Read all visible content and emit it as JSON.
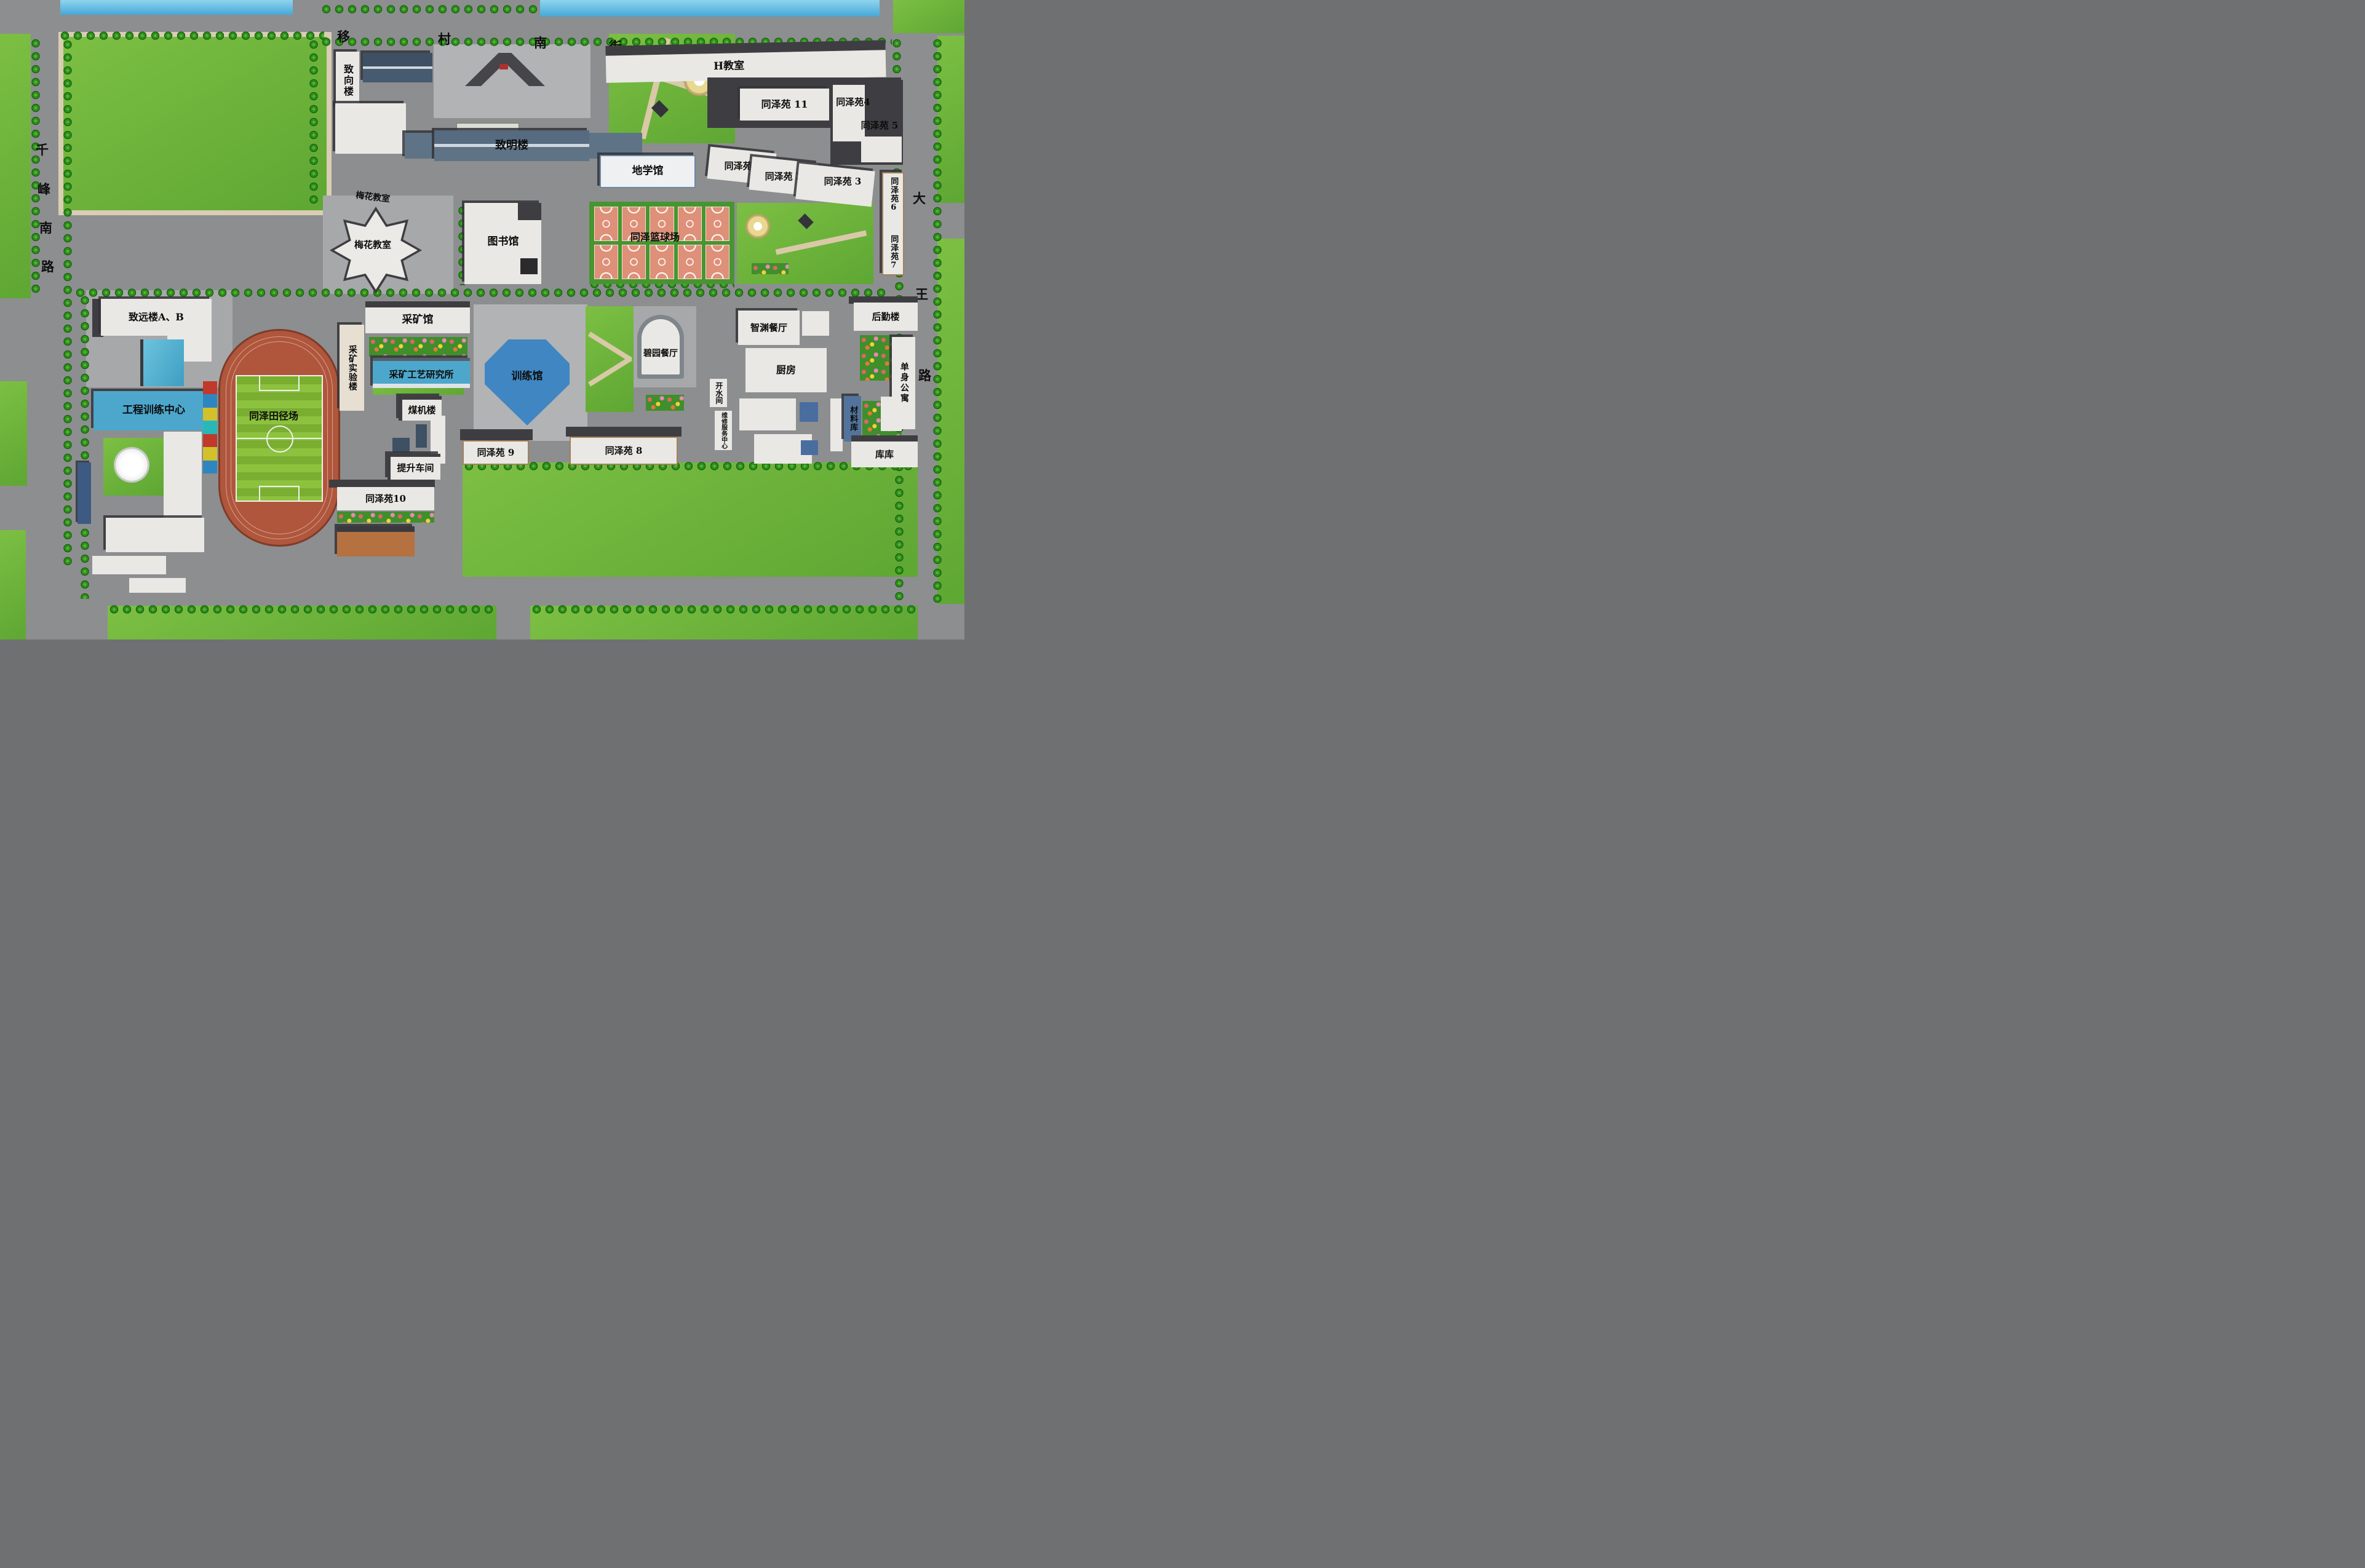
{
  "streets": {
    "north": [
      "移",
      "村",
      "南",
      "街"
    ],
    "west": [
      "千",
      "峰",
      "南",
      "路"
    ],
    "east": [
      "大",
      "王",
      "路"
    ]
  },
  "labels": {
    "zhixianglou": "致向楼",
    "zhiminglou": "致明楼",
    "h_jiaoshi": "H教室",
    "tzy11": "同泽苑 11",
    "tzy4": "同泽苑4",
    "tzy5": "同泽苑 5",
    "dixueguan": "地学馆",
    "tzy1": "同泽苑 1",
    "tzy2": "同泽苑 2",
    "tzy3": "同泽苑 3",
    "tzy6": "同泽苑6",
    "tzy7": "同泽苑7",
    "meihua_small": "梅花教室",
    "meihua": "梅花教室",
    "tushuguan": "图书馆",
    "lanqiuchang": "同泽篮球场",
    "zhiyuanlou_ab": "致远楼A、B",
    "gongcheng_xunlian": "工程训练中心",
    "tianjingchang": "同泽田径场",
    "caikuangguan": "采矿馆",
    "caikuang_shiyanlou": "采矿实验楼",
    "caikuang_gongyi": "采矿工艺研究所",
    "xunlianguan": "训练馆",
    "meijilou": "煤机楼",
    "tisheng_chejian": "提升车间",
    "tzy9": "同泽苑 9",
    "tzy8": "同泽苑 8",
    "tzy10": "同泽苑10",
    "biyuan_canting": "碧园餐厅",
    "zhiyuan_canting": "智渊餐厅",
    "chufang": "厨房",
    "houqinlou": "后勤楼",
    "danshen_gongyu": "单身公寓",
    "kaishuijian": "开水间",
    "weixiu_fuwu": "维修服务中心",
    "cailiaoku": "材料库",
    "kuku": "库库"
  },
  "facilities": {
    "basketball_court_count": 10
  },
  "colors": {
    "road_gray": "#8d8e90",
    "lawn_green": "#6db23a",
    "water_blue": "#5fb9e2",
    "building_white": "#e9e8e4",
    "teaching_blue": "#4da7cc",
    "track_orange": "#b0563c",
    "court_salmon": "#de9078",
    "gym_blue": "#3f86c2"
  }
}
